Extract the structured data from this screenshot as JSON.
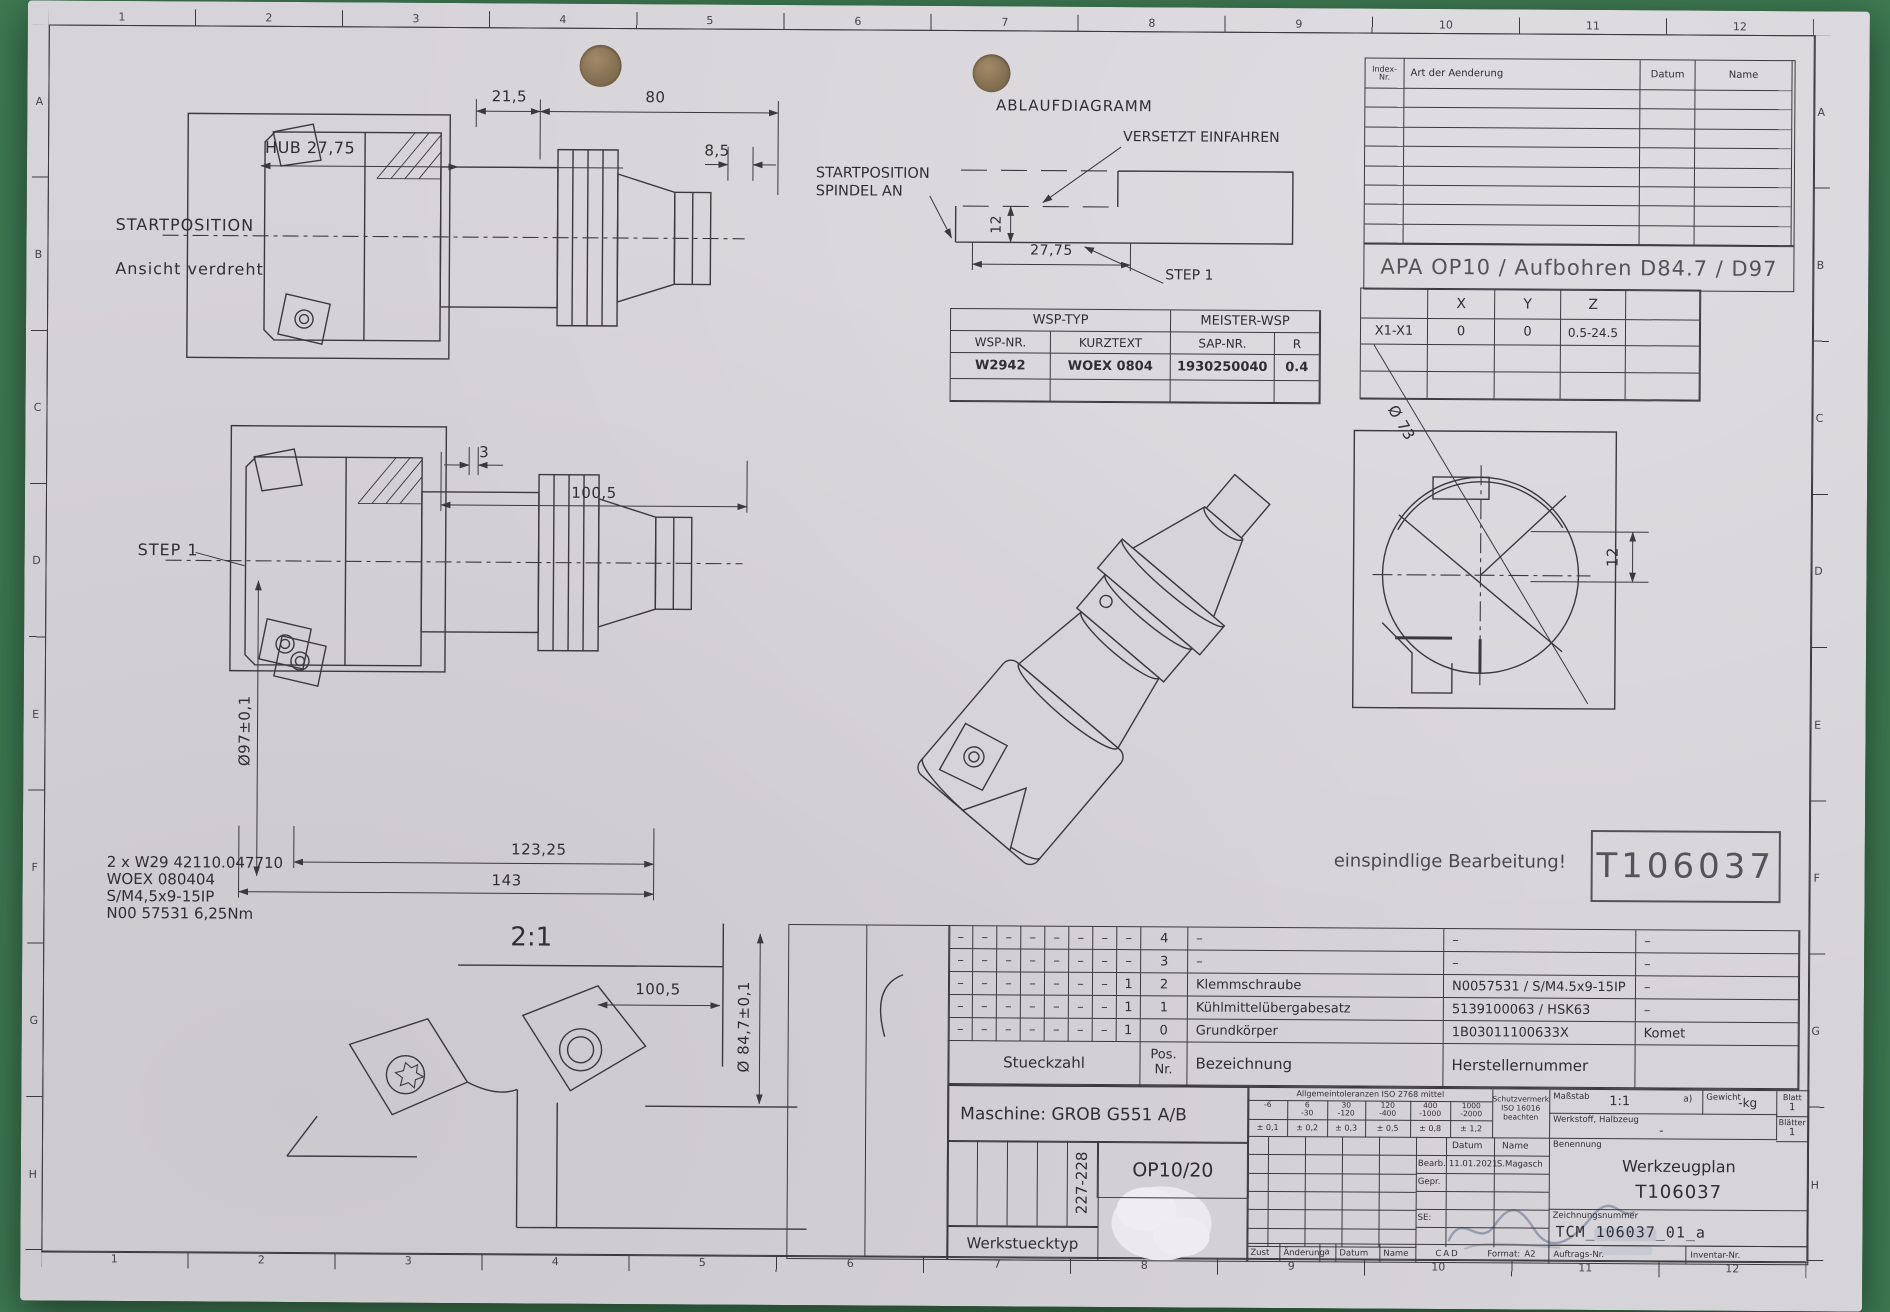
{
  "colors": {
    "backdrop": "#3e7a52",
    "paper": "#d7d4d9",
    "ink": "#3a393f"
  },
  "border": {
    "cols": [
      "1",
      "2",
      "3",
      "4",
      "5",
      "6",
      "7",
      "8",
      "9",
      "10",
      "11",
      "12"
    ],
    "rows": [
      "A",
      "B",
      "C",
      "D",
      "E",
      "F",
      "G",
      "H"
    ]
  },
  "revision": {
    "index": "Index-\nNr.",
    "change": "Art der Aenderung",
    "date": "Datum",
    "name": "Name"
  },
  "banner": "APA OP10 / Aufbohren D84.7 / D97",
  "xyz": {
    "x": "X",
    "y": "Y",
    "z": "Z",
    "row": "X1-X1",
    "vx": "0",
    "vy": "0",
    "vz": "0.5-24.5"
  },
  "wsp": {
    "typ": "WSP-TYP",
    "meister": "MEISTER-WSP",
    "nr": "WSP-NR.",
    "kurz": "KURZTEXT",
    "sap": "SAP-NR.",
    "r": "R",
    "v_nr": "W2942",
    "v_kurz": "WOEX 0804",
    "v_sap": "1930250040",
    "v_r": "0.4"
  },
  "ablauf": {
    "title": "ABLAUFDIAGRAMM",
    "versetzt": "VERSETZT EINFAHREN",
    "start1": "STARTPOSITION",
    "start2": "SPINDEL AN",
    "step": "STEP 1",
    "d12": "12",
    "d2775": "27,75"
  },
  "view1": {
    "d215": "21,5",
    "d80": "80",
    "d85": "8,5",
    "hub": "HUB 27,75",
    "start": "STARTPOSITION",
    "ansicht": "Ansicht verdreht",
    "d3": "3",
    "d1005": "100,5"
  },
  "view2": {
    "step": "STEP 1",
    "dia": "Ø97±0,1",
    "d12325": "123,25",
    "d143": "143"
  },
  "notes": {
    "l1": "2 x W29 42110.047710",
    "l2": "WOEX 080404",
    "l3": "S/M4,5x9-15IP",
    "l4": "N00 57531 6,25Nm"
  },
  "detail": {
    "scale": "2:1",
    "d1005": "100,5",
    "dia": "Ø 84,7±0,1"
  },
  "front": {
    "dia": "Ø 73",
    "d12": "12"
  },
  "iso_note": "einspindlige Bearbeitung!",
  "tool_id": "T106037",
  "parts": {
    "rows": [
      {
        "q": [
          "–",
          "–",
          "–",
          "–",
          "–",
          "–",
          "–",
          "–"
        ],
        "pos": "4",
        "name": "–",
        "mfr": "–",
        "maker": "–"
      },
      {
        "q": [
          "–",
          "–",
          "–",
          "–",
          "–",
          "–",
          "–",
          "–"
        ],
        "pos": "3",
        "name": "–",
        "mfr": "–",
        "maker": "–"
      },
      {
        "q": [
          "–",
          "–",
          "–",
          "–",
          "–",
          "–",
          "–",
          "1"
        ],
        "pos": "2",
        "name": "Klemmschraube",
        "mfr": "N0057531 / S/M4.5x9-15IP",
        "maker": "–"
      },
      {
        "q": [
          "–",
          "–",
          "–",
          "–",
          "–",
          "–",
          "–",
          "1"
        ],
        "pos": "1",
        "name": "Kühlmittelübergabesatz",
        "mfr": "5139100063 / HSK63",
        "maker": "–"
      },
      {
        "q": [
          "–",
          "–",
          "–",
          "–",
          "–",
          "–",
          "–",
          "1"
        ],
        "pos": "0",
        "name": "Grundkörper",
        "mfr": "1B03011100633X",
        "maker": "Komet"
      }
    ],
    "f_qty": "Stueckzahl",
    "f_pos": "Pos.\nNr.",
    "f_name": "Bezeichnung",
    "f_mfr": "Herstellernummer"
  },
  "machine": {
    "label": "Maschine: GROB G551 A/B",
    "op": "OP10/20",
    "range": "227-228",
    "wtype": "Werkstuecktyp"
  },
  "tb": {
    "tol_title": "Allgemeintoleranzen ISO 2768 mittel",
    "ranges": [
      "-6",
      "6\n-30",
      "30\n-120",
      "120\n-400",
      "400\n-1000",
      "1000\n-2000"
    ],
    "tols": [
      "± 0,1",
      "± 0,2",
      "± 0,3",
      "± 0,5",
      "± 0,8",
      "± 1,2"
    ],
    "schutz1": "Schutzvermerk",
    "schutz2": "ISO 16016",
    "schutz3": "beachten",
    "massstab_label": "Maßstab",
    "massstab": "1:1",
    "a_mark": "a)",
    "gewicht_label": "Gewicht",
    "gewicht": "-kg",
    "blatt_label": "Blatt",
    "blatt": "1",
    "blaetter_label": "Blätter",
    "blaetter": "1",
    "werkstoff_label": "Werkstoff, Halbzeug",
    "werkstoff": "-",
    "datum": "Datum",
    "name": "Name",
    "bearb": "Bearb.",
    "gepr": "Gepr.",
    "se": "SE:",
    "bearb_datum": "11.01.2021",
    "bearb_name": "S.Magasch",
    "benennung_label": "Benennung",
    "benennung1": "Werkzeugplan",
    "benennung2": "T106037",
    "znr_label": "Zeichnungsnummer",
    "znr": "TCM_106037_01_a",
    "zust": "Zust",
    "aenderung": "Änderung",
    "a": "a",
    "datum2": "Datum",
    "name2": "Name",
    "cad": "CAD",
    "format_label": "Format:",
    "format": "A2",
    "auftrag": "Auftrags-Nr.",
    "inventar": "Inventar-Nr."
  }
}
